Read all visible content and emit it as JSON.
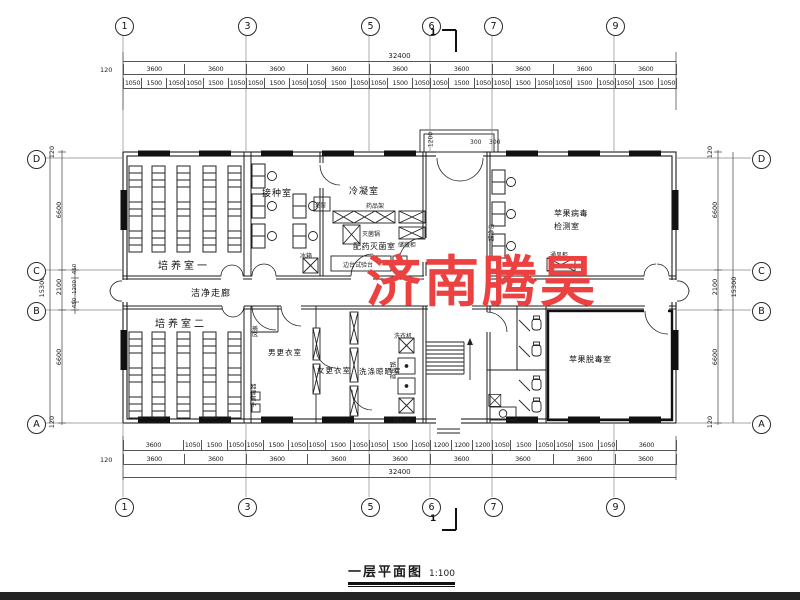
{
  "drawing": {
    "title": "一层平面图",
    "scale": "1:100",
    "watermark": "济南腾昊",
    "watermark_color": "#ec4141",
    "section_mark": "1"
  },
  "grid": {
    "cols": [
      "1",
      "3",
      "5",
      "6",
      "7",
      "9"
    ],
    "rows": [
      "D",
      "C",
      "B",
      "A"
    ]
  },
  "dims": {
    "top": {
      "total": "32400",
      "edge": "120",
      "bays": [
        "3600",
        "3600",
        "3600",
        "3600",
        "3600",
        "3600",
        "3600",
        "3600",
        "3600"
      ],
      "detail": [
        "1050",
        "1500",
        "1050",
        "1050",
        "1500",
        "1050",
        "1050",
        "1500",
        "1050",
        "1050",
        "1500",
        "1050",
        "1050",
        "1500",
        "1050",
        "1050",
        "1500",
        "1050",
        "1050",
        "1500",
        "1050",
        "1050",
        "1500",
        "1050",
        "1050",
        "1500",
        "1050"
      ]
    },
    "bottom": {
      "total": "32400",
      "edge": "120",
      "bays": [
        "3600",
        "3600",
        "3600",
        "3600",
        "3600",
        "3600",
        "3600",
        "3600",
        "3600"
      ],
      "detail": [
        "3600",
        "1050",
        "1500",
        "1050",
        "1050",
        "1500",
        "1050",
        "1050",
        "1500",
        "1050",
        "1050",
        "1500",
        "1050",
        "1200",
        "1200",
        "1200",
        "1050",
        "1500",
        "1050",
        "1050",
        "1500",
        "1050",
        "3600"
      ]
    },
    "left": {
      "total": "15300",
      "edge_top": "120",
      "edge_bottom": "120",
      "segments": [
        "6600",
        "2100",
        "6600"
      ],
      "inner": [
        "450",
        "1200",
        "450"
      ]
    },
    "right": {
      "total": "15300",
      "edge_top": "120",
      "edge_bottom": "120",
      "segments": [
        "6600",
        "2100",
        "6600"
      ]
    },
    "porch": {
      "depth": "1200",
      "w1": "300",
      "w2": "300"
    }
  },
  "rooms": {
    "culture1": "培养室一",
    "inoculation": "接种室",
    "condensation": "冷凝室",
    "prep_steril": "配药灭菌室",
    "virus_test_l1": "苹果病毒",
    "virus_test_l2": "检测室",
    "corridor": "洁净走廊",
    "culture2": "培养室二",
    "men_changing": "男更衣室",
    "women_changing": "女更衣室",
    "washing": "洗涤晾晒室",
    "detox": "苹果脱毒室"
  },
  "equipment": {
    "pass_window": "递窗",
    "fridge": "冰箱",
    "rack": "药品架",
    "sterilizer": "灭菌锅",
    "storage": "储藏柜",
    "side_bench": "边台试验台",
    "clean_bench": "超净台",
    "fume_hood": "通风柜",
    "air_shower": "风淋",
    "hand_sterilizer": "手消毒器",
    "washer": "洗衣机",
    "autoclave": "高压锅",
    "pure_water": "纯水机"
  }
}
